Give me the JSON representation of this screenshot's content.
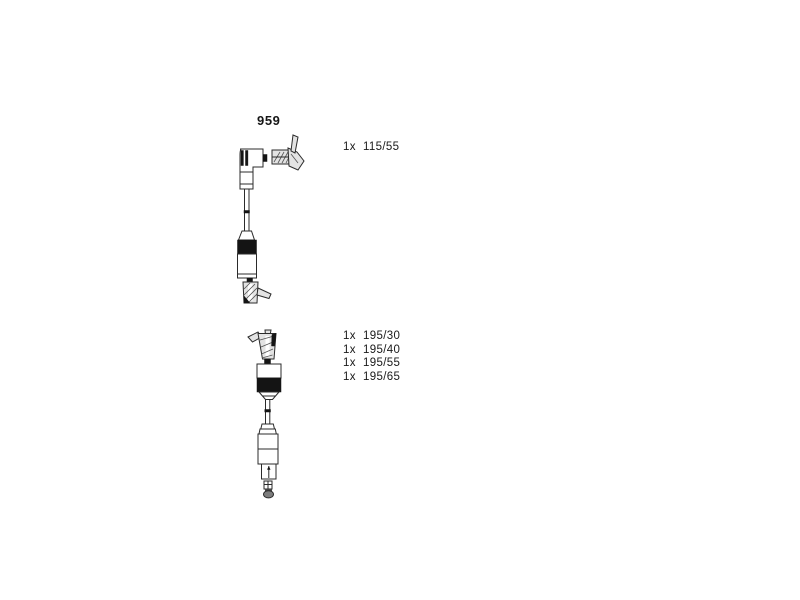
{
  "page": {
    "background": "#ffffff",
    "text_color": "#1a1a1a",
    "line_color": "#2b2b2b"
  },
  "part_number": "959",
  "cable_groups": [
    {
      "id": "angled-boot-cable",
      "illustration": "ignition-cable-angled-boot-drawing",
      "specs": [
        {
          "qty": "1x",
          "length": "115/55"
        }
      ]
    },
    {
      "id": "straight-boot-cable",
      "illustration": "ignition-cable-straight-boot-drawing",
      "specs": [
        {
          "qty": "1x",
          "length": "195/30"
        },
        {
          "qty": "1x",
          "length": "195/40"
        },
        {
          "qty": "1x",
          "length": "195/55"
        },
        {
          "qty": "1x",
          "length": "195/65"
        }
      ]
    }
  ]
}
